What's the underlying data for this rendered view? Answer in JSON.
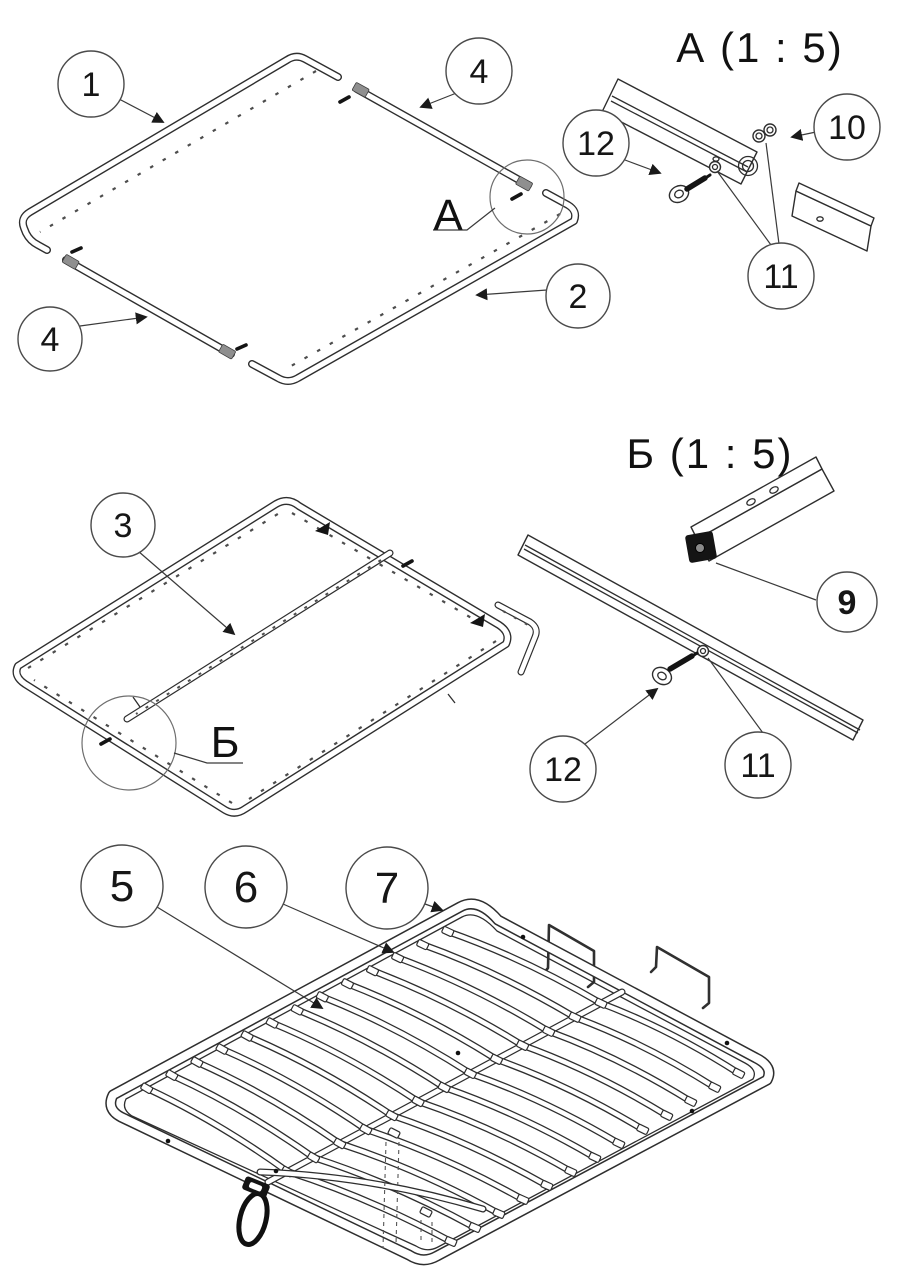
{
  "details": {
    "a": {
      "title": "А  (1 : 5)",
      "marker": "А"
    },
    "b": {
      "title": "Б  (1 : 5)",
      "marker": "Б"
    }
  },
  "callouts": {
    "c1": {
      "label": "1"
    },
    "c2": {
      "label": "2"
    },
    "c3": {
      "label": "3"
    },
    "c4a": {
      "label": "4"
    },
    "c4b": {
      "label": "4"
    },
    "c5": {
      "label": "5"
    },
    "c6": {
      "label": "6"
    },
    "c7": {
      "label": "7"
    },
    "c9": {
      "label": "9"
    },
    "c10": {
      "label": "10"
    },
    "c11a": {
      "label": "11"
    },
    "c11b": {
      "label": "11"
    },
    "c12a": {
      "label": "12"
    },
    "c12b": {
      "label": "12"
    }
  },
  "colors": {
    "line": "#2e2e2e",
    "background": "#ffffff",
    "hardware_black": "#141414",
    "connector_gray": "#8f8f8f"
  }
}
